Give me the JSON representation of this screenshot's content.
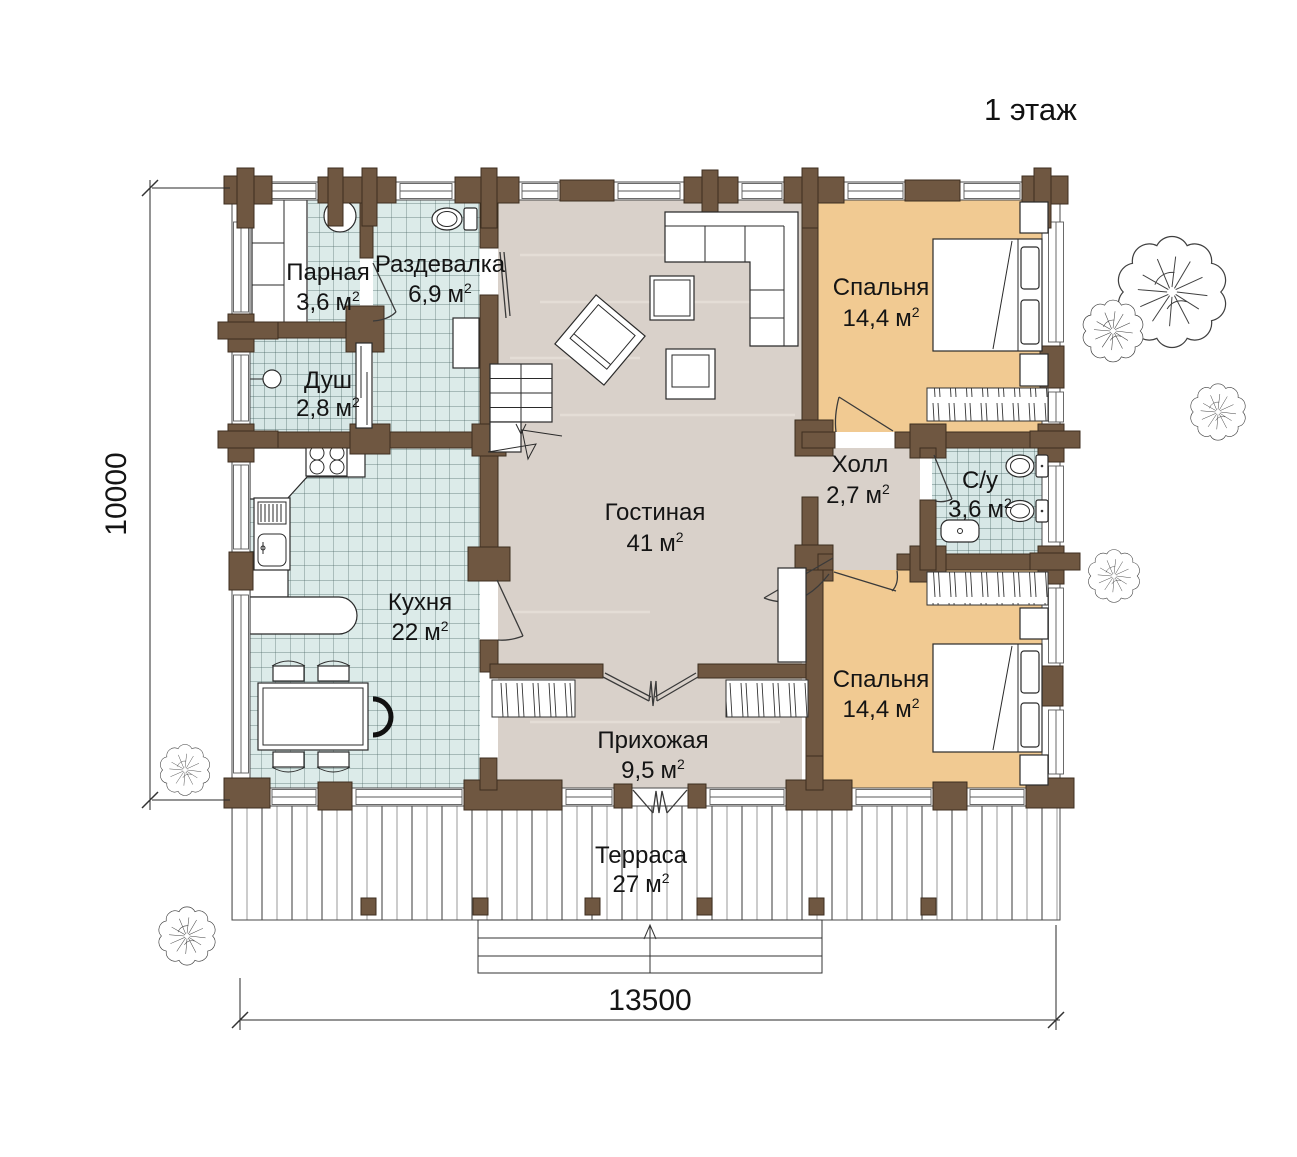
{
  "title": "1 этаж",
  "units": {
    "base": "м",
    "sup": "2"
  },
  "rooms": [
    {
      "id": "parnaya",
      "name": "Парная",
      "area": "3,6"
    },
    {
      "id": "razdevalka",
      "name": "Раздевалка",
      "area": "6,9"
    },
    {
      "id": "dush",
      "name": "Душ",
      "area": "2,8"
    },
    {
      "id": "kuhnya",
      "name": "Кухня",
      "area": "22"
    },
    {
      "id": "gostinaya",
      "name": "Гостиная",
      "area": "41"
    },
    {
      "id": "holl",
      "name": "Холл",
      "area": "2,7"
    },
    {
      "id": "su",
      "name": "С/у",
      "area": "3,6"
    },
    {
      "id": "spalnya1",
      "name": "Спальня",
      "area": "14,4"
    },
    {
      "id": "spalnya2",
      "name": "Спальня",
      "area": "14,4"
    },
    {
      "id": "prihozhaya",
      "name": "Прихожая",
      "area": "9,5"
    },
    {
      "id": "terrasa",
      "name": "Терраса",
      "area": "27"
    }
  ],
  "dimensions": {
    "width": "13500",
    "height": "10000"
  },
  "colors": {
    "wall_wood": "#6f5741",
    "tile_floor": "#dcebe9",
    "wood_floor": "#d9d1ca",
    "bedroom_floor": "#f1ca92",
    "outline": "#2a2a2a"
  }
}
